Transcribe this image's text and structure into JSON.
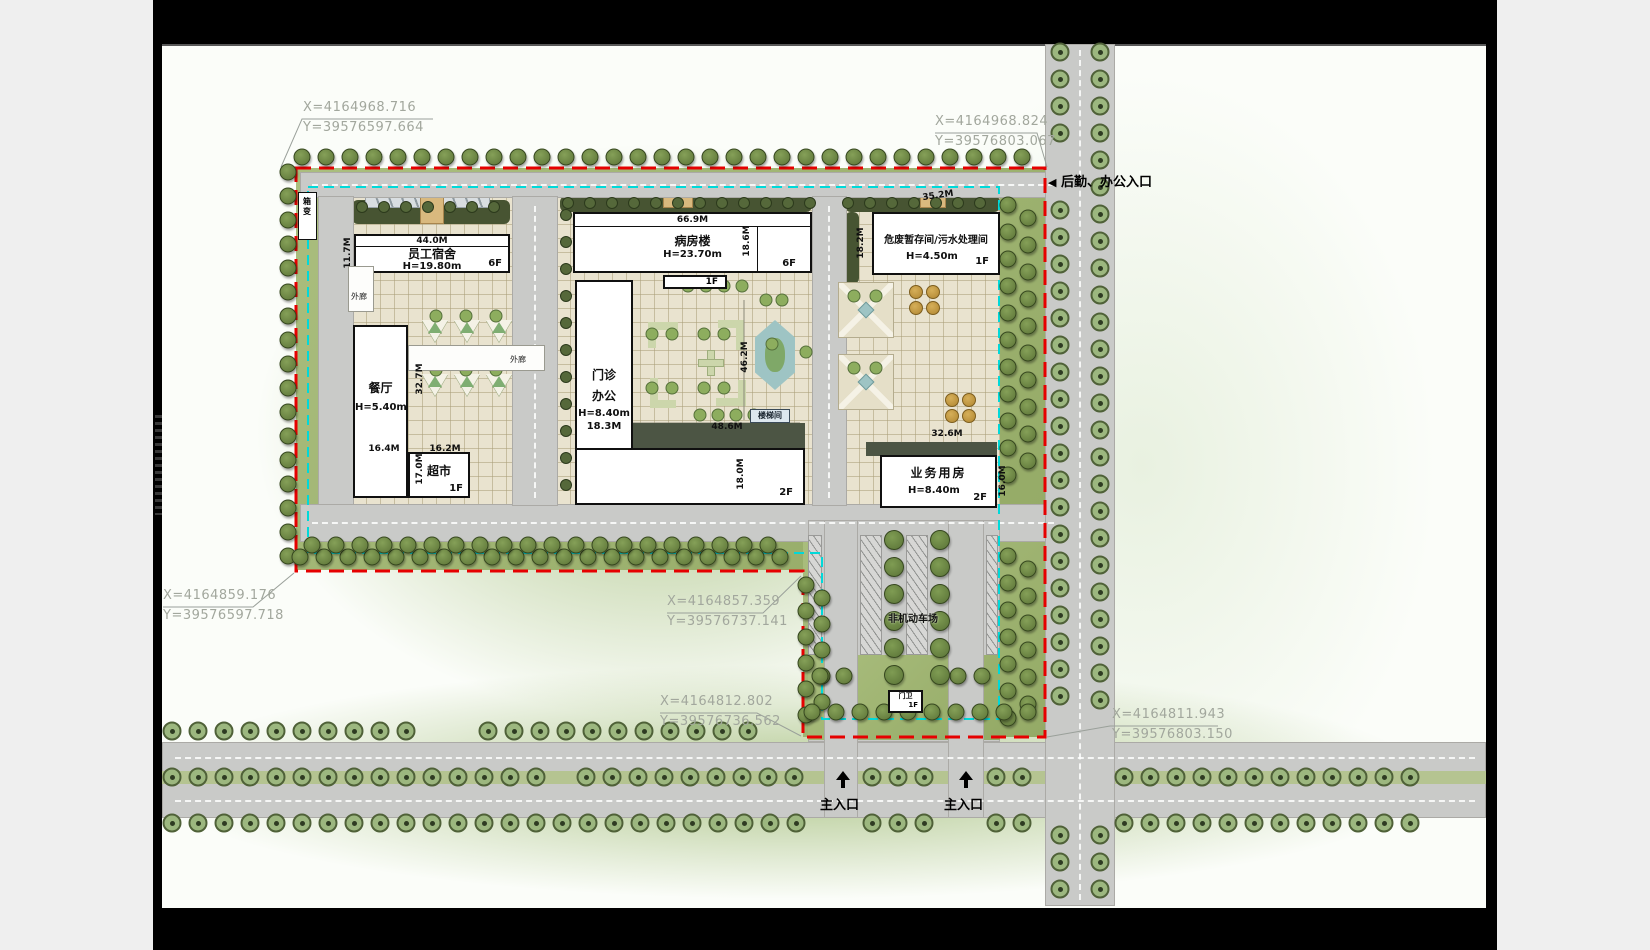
{
  "colors": {
    "boundary_red": "#e60000",
    "setback_cyan": "#00d9d9",
    "road_gray": "#c9cac8",
    "lawn_green": "#a3b878",
    "paving_beige": "#e9e3cf",
    "frame_black": "#000000",
    "paper_white": "#fbfdf9",
    "annotation_gray": "#a2a79d"
  },
  "coordinates": [
    {
      "x": "X=4164968.716",
      "y": "Y=39576597.664"
    },
    {
      "x": "X=4164968.824",
      "y": "Y=39576803.067"
    },
    {
      "x": "X=4164859.176",
      "y": "Y=39576597.718"
    },
    {
      "x": "X=4164857.359",
      "y": "Y=39576737.141"
    },
    {
      "x": "X=4164812.802",
      "y": "Y=39576736.562"
    },
    {
      "x": "X=4164811.943",
      "y": "Y=39576803.150"
    }
  ],
  "entrances": {
    "logistics": "后勤、办公入口",
    "main": "主入口"
  },
  "buildings": {
    "dormitory": {
      "name": "员工宿舍",
      "height": "H=19.80m",
      "floors": "6F"
    },
    "ward": {
      "name": "病房楼",
      "height": "H=23.70m",
      "floors": "6F",
      "annex_floors": "1F"
    },
    "hazard": {
      "name": "危废暂存间/污水处理间",
      "height": "H=4.50m",
      "floors": "1F"
    },
    "canteen": {
      "name": "餐厅",
      "height": "H=5.40m"
    },
    "market": {
      "name": "超市",
      "floors": "1F"
    },
    "outpatient": {
      "name1": "门诊",
      "name2": "办公",
      "height": "H=8.40m",
      "floors": "2F"
    },
    "business": {
      "name": "业务用房",
      "height": "H=8.40m",
      "floors": "2F"
    },
    "guard": {
      "name": "门卫",
      "floors": "1F"
    },
    "transformer": {
      "name": "箱变"
    },
    "stair": {
      "name": "楼梯间"
    }
  },
  "labels": {
    "corridor": "外廊",
    "bike_parking": "非机动车场"
  },
  "dimensions": {
    "dorm_w": "44.0M",
    "dorm_d": "11.7M",
    "ward_w": "66.9M",
    "ward_d": "18.6M",
    "hazard_w": "35.2M",
    "hazard_d": "18.2M",
    "canteen_w": "16.4M",
    "market_w": "16.2M",
    "market_d": "17.0M",
    "canteen_court_d": "32.7M",
    "outpatient_w": "18.3M",
    "court_d": "46.2M",
    "court_w": "48.6M",
    "wing_d": "18.0M",
    "business_w": "32.6M",
    "business_d": "16.0M"
  },
  "decor": {
    "tree_rows": [
      [
        "b",
        302,
        157,
        31,
        24,
        0
      ],
      [
        "b",
        288,
        172,
        17,
        0,
        24
      ],
      [
        "b",
        300,
        557,
        21,
        24,
        0
      ],
      [
        "b",
        312,
        545,
        20,
        24,
        0
      ],
      [
        "b",
        1008,
        205,
        11,
        0,
        27
      ],
      [
        "b",
        1008,
        556,
        7,
        0,
        27
      ],
      [
        "b",
        1028,
        218,
        10,
        0,
        27
      ],
      [
        "b",
        1028,
        569,
        6,
        0,
        27
      ],
      [
        "b",
        806,
        585,
        6,
        0,
        26
      ],
      [
        "b",
        822,
        598,
        5,
        0,
        26
      ],
      [
        "b",
        812,
        712,
        10,
        24,
        0
      ],
      [
        "b",
        820,
        676,
        2,
        24,
        0
      ],
      [
        "b",
        958,
        676,
        2,
        24,
        0
      ],
      [
        "h",
        362,
        207,
        7,
        22,
        0
      ],
      [
        "h",
        568,
        203,
        12,
        22,
        0
      ],
      [
        "h",
        848,
        203,
        7,
        22,
        0
      ],
      [
        "h",
        566,
        215,
        11,
        0,
        27
      ],
      [
        "h",
        646,
        430,
        8,
        21,
        0
      ],
      [
        "r",
        1060,
        52,
        4,
        0,
        27
      ],
      [
        "r",
        1060,
        210,
        19,
        0,
        27
      ],
      [
        "r",
        1060,
        835,
        3,
        0,
        27
      ],
      [
        "r",
        1100,
        52,
        25,
        0,
        27
      ],
      [
        "r",
        1100,
        835,
        3,
        0,
        27
      ],
      [
        "r",
        172,
        731,
        10,
        26,
        0
      ],
      [
        "r",
        488,
        731,
        11,
        26,
        0
      ],
      [
        "r",
        172,
        777,
        15,
        26,
        0
      ],
      [
        "r",
        586,
        777,
        9,
        26,
        0
      ],
      [
        "r",
        872,
        777,
        3,
        26,
        0
      ],
      [
        "r",
        996,
        777,
        2,
        26,
        0
      ],
      [
        "r",
        1124,
        777,
        12,
        26,
        0
      ],
      [
        "r",
        172,
        823,
        25,
        26,
        0
      ],
      [
        "r",
        872,
        823,
        3,
        26,
        0
      ],
      [
        "r",
        996,
        823,
        2,
        26,
        0
      ],
      [
        "r",
        1124,
        823,
        12,
        26,
        0
      ],
      [
        "p",
        894,
        540,
        6,
        0,
        27
      ],
      [
        "p",
        940,
        540,
        6,
        0,
        27
      ],
      [
        "g",
        436,
        316,
        3,
        30,
        0
      ],
      [
        "g",
        436,
        370,
        3,
        30,
        0
      ],
      [
        "g",
        688,
        286,
        4,
        18,
        0
      ],
      [
        "g",
        652,
        334,
        2,
        20,
        0
      ],
      [
        "g",
        704,
        334,
        2,
        20,
        0
      ],
      [
        "g",
        652,
        388,
        2,
        20,
        0
      ],
      [
        "g",
        704,
        388,
        2,
        20,
        0
      ],
      [
        "g",
        766,
        300,
        2,
        16,
        0
      ],
      [
        "g",
        772,
        344,
        1,
        0,
        0
      ],
      [
        "g",
        806,
        352,
        1,
        0,
        0
      ],
      [
        "g",
        700,
        415,
        4,
        18,
        0
      ],
      [
        "g",
        854,
        296,
        2,
        22,
        0
      ],
      [
        "g",
        854,
        368,
        2,
        22,
        0
      ],
      [
        "o",
        916,
        292,
        2,
        17,
        0
      ],
      [
        "o",
        916,
        308,
        2,
        17,
        0
      ],
      [
        "o",
        952,
        400,
        2,
        17,
        0
      ],
      [
        "o",
        952,
        416,
        2,
        17,
        0
      ]
    ]
  }
}
